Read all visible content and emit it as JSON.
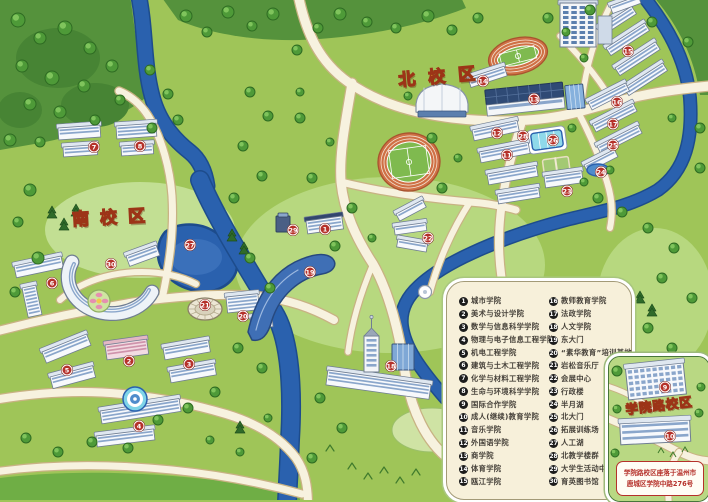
{
  "campus_labels": {
    "north": "北校区",
    "south": "南校区",
    "inset": "学院路校区"
  },
  "inset": {
    "address_line1": "学院路校区座落于温州市",
    "address_line2": "鹿城区学院中路276号"
  },
  "legend": {
    "columns": [
      {
        "items": [
          {
            "n": "1",
            "label": "城市学院"
          },
          {
            "n": "2",
            "label": "美术与设计学院"
          },
          {
            "n": "3",
            "label": "数学与信息科学学院"
          },
          {
            "n": "4",
            "label": "物理与电子信息工程学院"
          },
          {
            "n": "5",
            "label": "机电工程学院"
          },
          {
            "n": "6",
            "label": "建筑与土木工程学院"
          },
          {
            "n": "7",
            "label": "化学与材料工程学院"
          },
          {
            "n": "8",
            "label": "生命与环境科学学院"
          },
          {
            "n": "9",
            "label": "国际合作学院"
          },
          {
            "n": "10",
            "label": "成人(继续)教育学院"
          },
          {
            "n": "11",
            "label": "音乐学院"
          },
          {
            "n": "12",
            "label": "外国语学院"
          },
          {
            "n": "13",
            "label": "商学院"
          },
          {
            "n": "14",
            "label": "体育学院"
          },
          {
            "n": "15",
            "label": "瓯江学院"
          }
        ]
      },
      {
        "items": [
          {
            "n": "16",
            "label": "教师教育学院"
          },
          {
            "n": "17",
            "label": "法政学院"
          },
          {
            "n": "18",
            "label": "人文学院"
          },
          {
            "n": "19",
            "label": "东大门"
          },
          {
            "n": "20",
            "label": "“素华教育”培训基地"
          },
          {
            "n": "21",
            "label": "岩松音乐厅"
          },
          {
            "n": "22",
            "label": "会展中心"
          },
          {
            "n": "23",
            "label": "行政楼"
          },
          {
            "n": "24",
            "label": "半月湖"
          },
          {
            "n": "25",
            "label": "北大门"
          },
          {
            "n": "26",
            "label": "拓展训练场"
          },
          {
            "n": "27",
            "label": "人工湖"
          },
          {
            "n": "28",
            "label": "北教学楼群"
          },
          {
            "n": "29",
            "label": "大学生活动中心"
          },
          {
            "n": "30",
            "label": "育英图书馆"
          }
        ]
      }
    ]
  },
  "map_markers": [
    {
      "n": "1",
      "x": 325,
      "y": 229
    },
    {
      "n": "2",
      "x": 129,
      "y": 361
    },
    {
      "n": "3",
      "x": 189,
      "y": 364
    },
    {
      "n": "4",
      "x": 139,
      "y": 426
    },
    {
      "n": "5",
      "x": 67,
      "y": 370
    },
    {
      "n": "6",
      "x": 52,
      "y": 283
    },
    {
      "n": "7",
      "x": 94,
      "y": 147
    },
    {
      "n": "8",
      "x": 140,
      "y": 146
    },
    {
      "n": "9",
      "x": 665,
      "y": 387
    },
    {
      "n": "10",
      "x": 670,
      "y": 436
    },
    {
      "n": "11",
      "x": 507,
      "y": 155
    },
    {
      "n": "12",
      "x": 497,
      "y": 133
    },
    {
      "n": "13",
      "x": 534,
      "y": 99
    },
    {
      "n": "14",
      "x": 483,
      "y": 81
    },
    {
      "n": "15",
      "x": 628,
      "y": 51
    },
    {
      "n": "16",
      "x": 617,
      "y": 102
    },
    {
      "n": "17",
      "x": 613,
      "y": 124
    },
    {
      "n": "18",
      "x": 391,
      "y": 366
    },
    {
      "n": "19",
      "x": 310,
      "y": 272
    },
    {
      "n": "20",
      "x": 243,
      "y": 316
    },
    {
      "n": "21",
      "x": 205,
      "y": 305
    },
    {
      "n": "22",
      "x": 428,
      "y": 238
    },
    {
      "n": "23",
      "x": 567,
      "y": 191
    },
    {
      "n": "24",
      "x": 601,
      "y": 172
    },
    {
      "n": "25",
      "x": 613,
      "y": 145
    },
    {
      "n": "26",
      "x": 553,
      "y": 140
    },
    {
      "n": "27",
      "x": 190,
      "y": 245
    },
    {
      "n": "28",
      "x": 523,
      "y": 136
    },
    {
      "n": "29",
      "x": 293,
      "y": 230
    },
    {
      "n": "30",
      "x": 111,
      "y": 264
    }
  ],
  "colors": {
    "marker_red": "#b5312a",
    "legend_badge": "#1c1c1c",
    "title_yellow": "#ffd83a",
    "title_outline": "#9c3417",
    "address_red": "#b5312a"
  }
}
